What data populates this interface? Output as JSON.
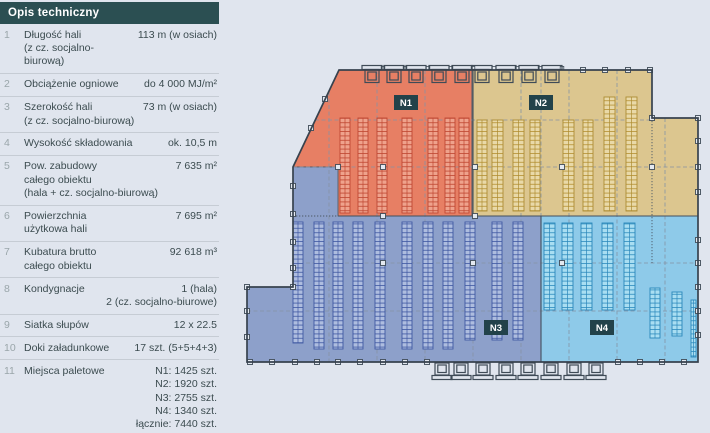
{
  "page": {
    "background": "#e0e5ee"
  },
  "panel": {
    "title": "Opis techniczny",
    "rows": [
      {
        "num": "1",
        "label": "Długość hali\n(z cz. socjalno-\nbiurową)",
        "value": "113 m (w osiach)"
      },
      {
        "num": "2",
        "label": "Obciążenie ogniowe",
        "value": "do 4 000 MJ/m²"
      },
      {
        "num": "3",
        "label": "Szerokość hali\n(z cz. socjalno-biurową)",
        "value": "73 m (w osiach)"
      },
      {
        "num": "4",
        "label": "Wysokość składowania",
        "value": "ok. 10,5 m"
      },
      {
        "num": "5",
        "label": "Pow. zabudowy\ncałego obiektu\n(hala + cz. socjalno-biurową)",
        "value": "7 635 m²"
      },
      {
        "num": "6",
        "label": "Powierzchnia\nużytkowa hali",
        "value": "7 695 m²"
      },
      {
        "num": "7",
        "label": "Kubatura brutto\ncałego obiektu",
        "value": "92 618 m³"
      },
      {
        "num": "8",
        "label": "Kondygnacje",
        "value": "1 (hala)\n2 (cz. socjalno-biurowe)"
      },
      {
        "num": "9",
        "label": "Siatka słupów",
        "value": "12 x 22.5"
      },
      {
        "num": "10",
        "label": "Doki załadunkowe",
        "value": "17 szt. (5+5+4+3)"
      },
      {
        "num": "11",
        "label": "Miejsca paletowe",
        "value": "N1: 1425 szt.\nN2: 1920 szt.\nN3: 2755 szt.\nN4: 1340 szt.\nłącznie: 7440 szt."
      }
    ]
  },
  "plan": {
    "colors": {
      "label_bg": "#22424a",
      "header_bg": "#2b4f52",
      "outline": "#37424e"
    },
    "zones": [
      {
        "id": "N1",
        "label": "N1",
        "fill": "#e77f64"
      },
      {
        "id": "N2",
        "label": "N2",
        "fill": "#dcc68f"
      },
      {
        "id": "N3",
        "label": "N3",
        "fill": "#8da0ca"
      },
      {
        "id": "N4",
        "label": "N4",
        "fill": "#8ecae9"
      }
    ]
  }
}
